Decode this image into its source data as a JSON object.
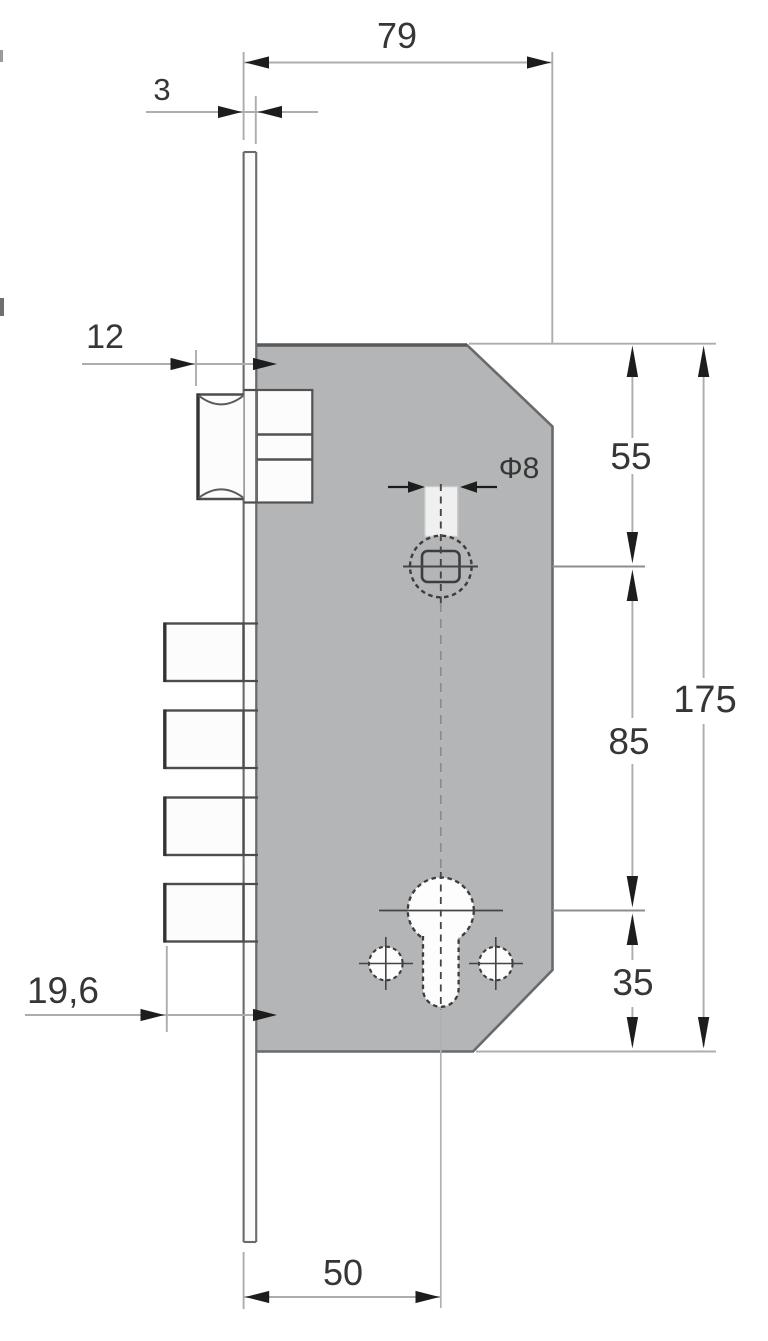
{
  "drawing": {
    "type": "technical-drawing",
    "subject": "mortise lock side view with dimensions",
    "dimensions": {
      "total_width": "79",
      "faceplate_thickness": "3",
      "latch_projection": "12",
      "deadbolt_projection": "19,6",
      "backset": "50",
      "top_to_follower": "55",
      "follower_to_cylinder": "85",
      "cylinder_to_bottom": "35",
      "total_height": "175",
      "follower_square": "Φ8"
    },
    "colors": {
      "background": "#ffffff",
      "body_fill": "#b4b5b6",
      "body_outline": "#696a6c",
      "detail_outline": "#3d3d3d",
      "white_part_fill": "#fcfcfc",
      "dimension_line": "#adadad",
      "arrow": "#1d1d1d",
      "text": "#363636"
    }
  }
}
